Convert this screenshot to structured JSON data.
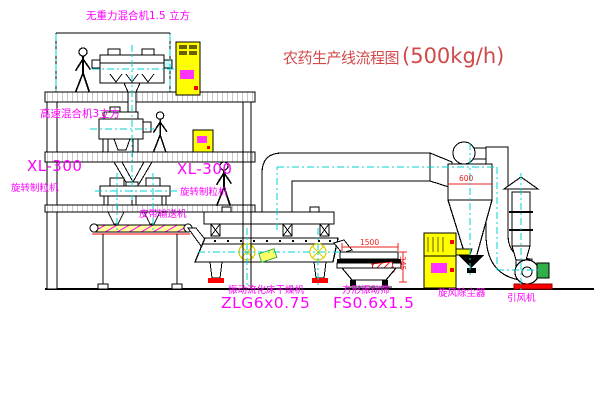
{
  "title": {
    "text_cn": "农药生产线流程图",
    "capacity": "(500kg/h)"
  },
  "labels": {
    "gravity_mixer": "无重力混合机1.5 立方",
    "high_speed_mixer": "高速混合机3立方",
    "granulator_left_model": "XL-300",
    "granulator_left_name": "旋转制粒机",
    "granulator_mid_model": "XL-300",
    "granulator_mid_name": "旋转制粒机",
    "belt_conveyor": "皮带输送机",
    "dryer_name": "振动流化床干燥机",
    "dryer_model": "ZLG6x0.75",
    "screen_name": "方形振动筛",
    "screen_model": "FS0.6x1.5",
    "cyclone": "旋风除尘器",
    "fan": "引风机"
  },
  "dimensions": {
    "cyclone_diameter": "600",
    "screen_length": "1500",
    "screen_height": "345"
  },
  "colors": {
    "label_magenta": "#ff00ff",
    "title_red": "#d04a4a",
    "dimension_red": "#ee2222",
    "centerline_cyan": "#00d5d5",
    "equipment_yellow": "#ffff00",
    "motor_green": "#2fae4a",
    "base_red": "#ff0000",
    "line_black": "#000000"
  }
}
